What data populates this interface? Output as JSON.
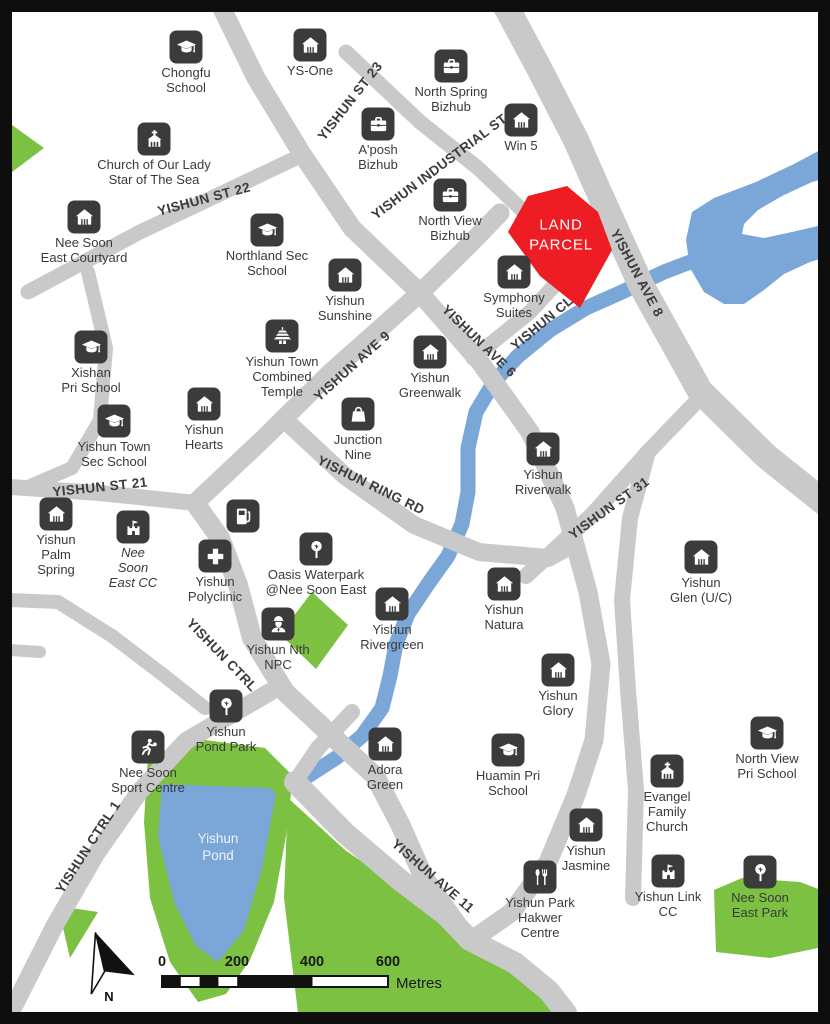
{
  "map_name": "Yishun land parcel location map",
  "colors": {
    "road": "#c9c9c9",
    "water": "#7aa7d8",
    "park": "#7dc142",
    "parcel": "#ee1c23",
    "icon_bg": "#3b3b3b",
    "label_text": "#3a3a3a"
  },
  "land_parcel": {
    "label": "LAND\nPARCEL"
  },
  "water": {
    "pond_label": "Yishun\nPond"
  },
  "legend": {
    "north_label": "N",
    "scale_ticks": [
      "0",
      "200",
      "400",
      "600"
    ],
    "scale_unit": "Metres"
  },
  "roads": {
    "st23": "YISHUN ST 23",
    "st22": "YISHUN ST 22",
    "ind1": "YISHUN INDUSTRIAL ST 1",
    "ave8": "YISHUN AVE 8",
    "ave9": "YISHUN AVE 9",
    "ave6": "YISHUN AVE 6",
    "cl": "YISHUN CL",
    "ring": "YISHUN RING RD",
    "st21": "YISHUN ST 21",
    "st31": "YISHUN ST 31",
    "ctrl": "YISHUN CTRL",
    "ctrl1": "YISHUN CTRL 1",
    "ave11": "YISHUN AVE 11"
  },
  "pois": {
    "chongfu": {
      "label": "Chongfu\nSchool",
      "icon": "graduation-cap"
    },
    "ysone": {
      "label": "YS-One",
      "icon": "home"
    },
    "northspring": {
      "label": "North Spring\nBizhub",
      "icon": "briefcase"
    },
    "aposh": {
      "label": "A'posh\nBizhub",
      "icon": "briefcase"
    },
    "win5": {
      "label": "Win 5",
      "icon": "home"
    },
    "ourlady": {
      "label": "Church of Our Lady\nStar of The Sea",
      "icon": "church"
    },
    "courtyard": {
      "label": "Nee Soon\nEast Courtyard",
      "icon": "home"
    },
    "northland": {
      "label": "Northland Sec\nSchool",
      "icon": "graduation-cap"
    },
    "nvbizhub": {
      "label": "North View\nBizhub",
      "icon": "briefcase"
    },
    "symphony": {
      "label": "Symphony\nSuites",
      "icon": "home"
    },
    "sunshine": {
      "label": "Yishun\nSunshine",
      "icon": "home"
    },
    "temple": {
      "label": "Yishun Town\nCombined\nTemple",
      "icon": "temple"
    },
    "xishan": {
      "label": "Xishan\nPri School",
      "icon": "graduation-cap"
    },
    "greenwalk": {
      "label": "Yishun\nGreenwalk",
      "icon": "home"
    },
    "junction9": {
      "label": "Junction\nNine",
      "icon": "shopping-bag"
    },
    "ytss": {
      "label": "Yishun Town\nSec School",
      "icon": "graduation-cap"
    },
    "hearts": {
      "label": "Yishun\nHearts",
      "icon": "home"
    },
    "riverwalk": {
      "label": "Yishun\nRiverwalk",
      "icon": "home"
    },
    "palmspring": {
      "label": "Yishun\nPalm\nSpring",
      "icon": "home"
    },
    "nscc": {
      "label": "Nee\nSoon\nEast CC",
      "icon": "fort-flag"
    },
    "fuel": {
      "label": "",
      "icon": "fuel-pump"
    },
    "polyclinic": {
      "label": "Yishun\nPolyclinic",
      "icon": "medical-cross"
    },
    "oasis": {
      "label": "Oasis Waterpark\n@Nee Soon East",
      "icon": "tree"
    },
    "npc": {
      "label": "Yishun Nth\nNPC",
      "icon": "police"
    },
    "rivergreen": {
      "label": "Yishun\nRivergreen",
      "icon": "home"
    },
    "natura": {
      "label": "Yishun\nNatura",
      "icon": "home"
    },
    "glen": {
      "label": "Yishun\nGlen (U/C)",
      "icon": "home"
    },
    "glory": {
      "label": "Yishun\nGlory",
      "icon": "home"
    },
    "pondpark": {
      "label": "Yishun\nPond Park",
      "icon": "tree"
    },
    "sport": {
      "label": "Nee Soon\nSport Centre",
      "icon": "runner"
    },
    "adora": {
      "label": "Adora\nGreen",
      "icon": "home"
    },
    "huamin": {
      "label": "Huamin Pri\nSchool",
      "icon": "graduation-cap"
    },
    "nvpri": {
      "label": "North View\nPri School",
      "icon": "graduation-cap"
    },
    "evangel": {
      "label": "Evangel\nFamily\nChurch",
      "icon": "church"
    },
    "jasmine": {
      "label": "Yishun\nJasmine",
      "icon": "home"
    },
    "hawker": {
      "label": "Yishun Park\nHakwer\nCentre",
      "icon": "cutlery"
    },
    "linkcc": {
      "label": "Yishun Link\nCC",
      "icon": "fort-flag"
    },
    "nspark": {
      "label": "Nee Soon\nEast Park",
      "icon": "tree"
    }
  }
}
